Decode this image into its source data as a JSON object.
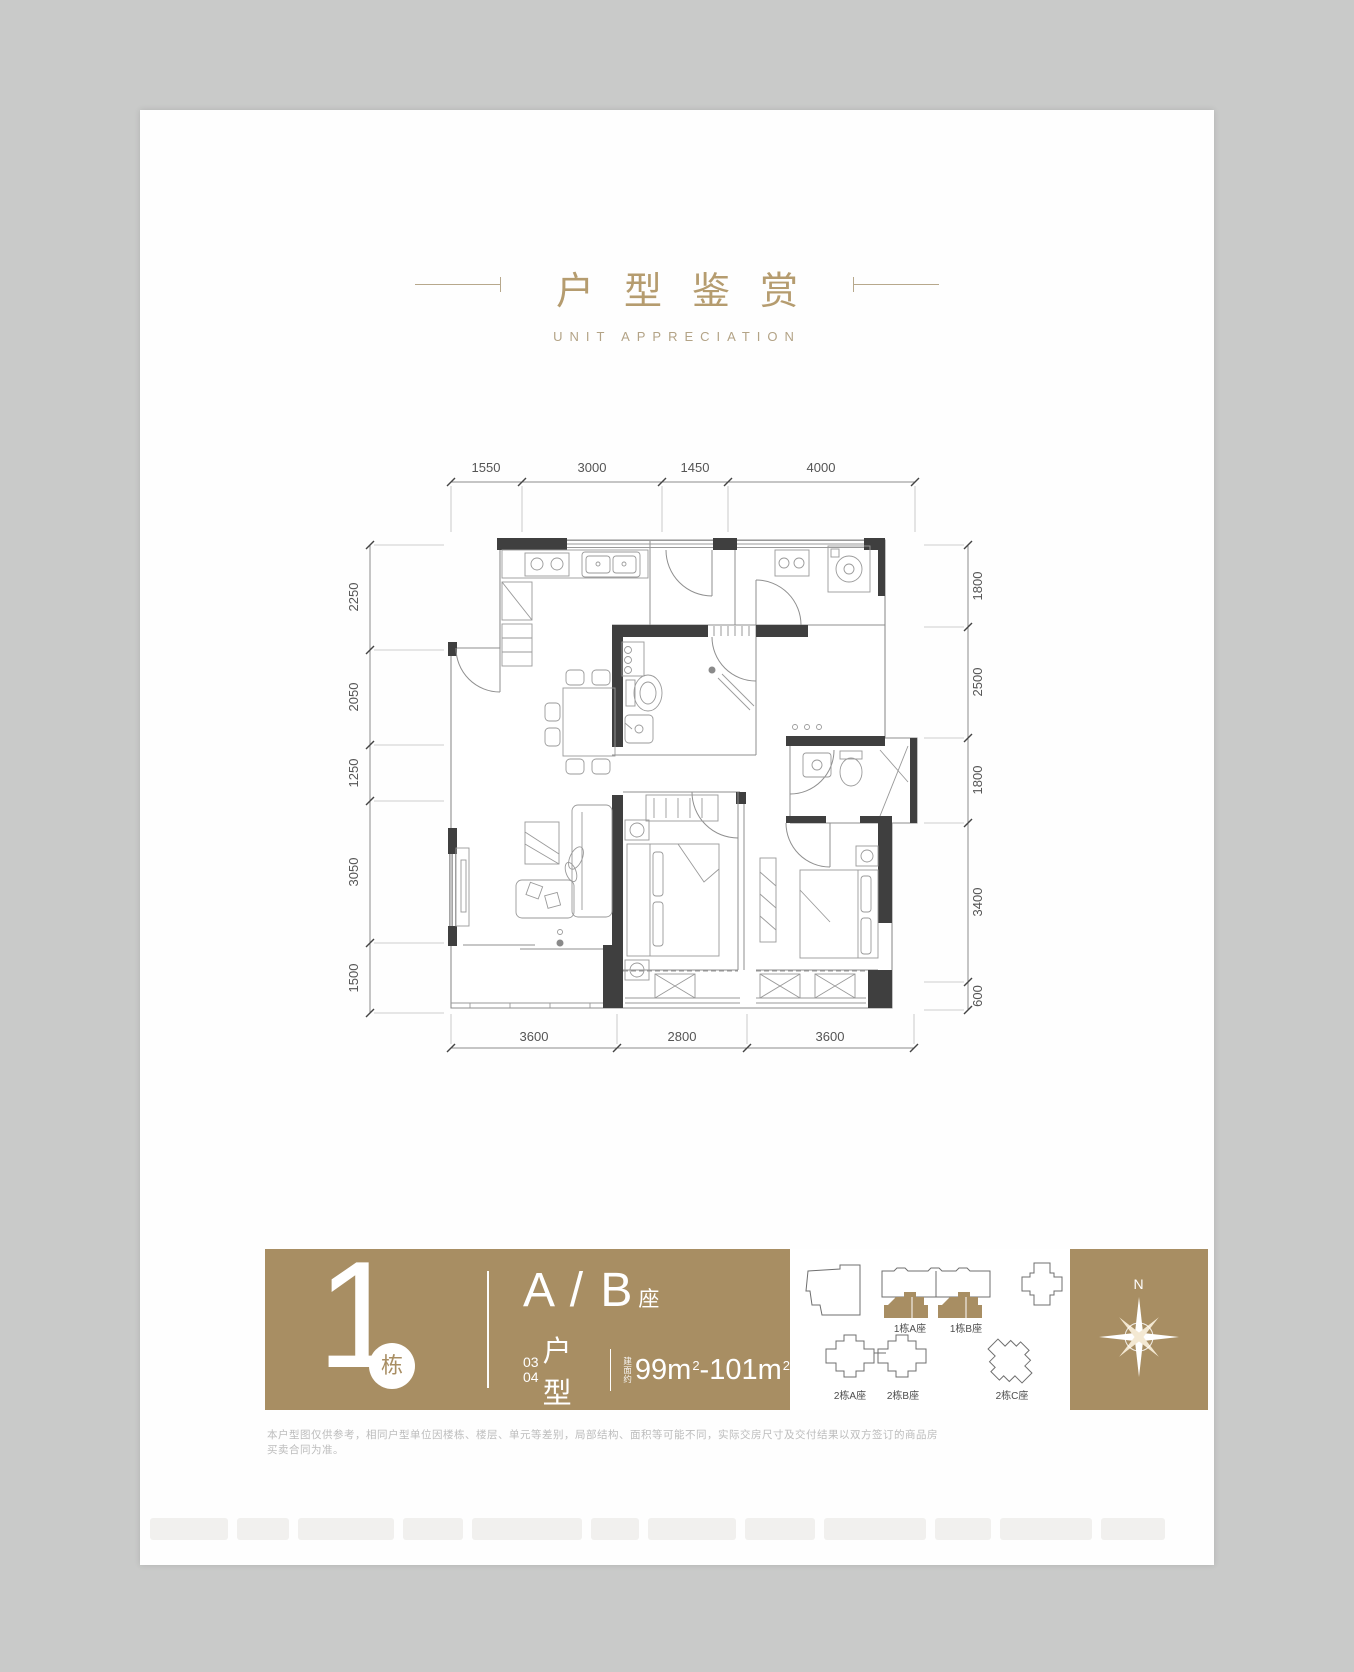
{
  "header": {
    "title": "户型鉴赏",
    "subtitle": "UNIT APPRECIATION"
  },
  "plan": {
    "dims": {
      "top": [
        "1550",
        "3000",
        "1450",
        "4000"
      ],
      "left": [
        "2250",
        "2050",
        "1250",
        "3050",
        "1500"
      ],
      "right": [
        "1800",
        "2500",
        "1800",
        "3400",
        "600"
      ],
      "bottom": [
        "3600",
        "2800",
        "3600"
      ]
    }
  },
  "band": {
    "building_number": "1",
    "building_suffix": "栋",
    "block_label": "A / B",
    "block_suffix": "座",
    "unit_no_1": "03",
    "unit_no_2": "04",
    "unit_type_label": "户型",
    "area_prefix_1": "建",
    "area_prefix_2": "面",
    "area_prefix_3": "约",
    "area_from": "99m",
    "area_sup_1": "2",
    "area_separator": "-",
    "area_to": "101m",
    "area_sup_2": "2"
  },
  "site_map": {
    "b1a": "1栋A座",
    "b1b": "1栋B座",
    "b2a": "2栋A座",
    "b2b": "2栋B座",
    "b2c": "2栋C座",
    "compass_label": "N"
  },
  "disclaimer": "本户型图仅供参考，相同户型单位因楼栋、楼层、单元等差别，局部结构、面积等可能不同，实际交房尺寸及交付结果以双方签订的商品房买卖合同为准。",
  "colors": {
    "gold": "#a88e63",
    "wall": "#3f3f3f"
  }
}
